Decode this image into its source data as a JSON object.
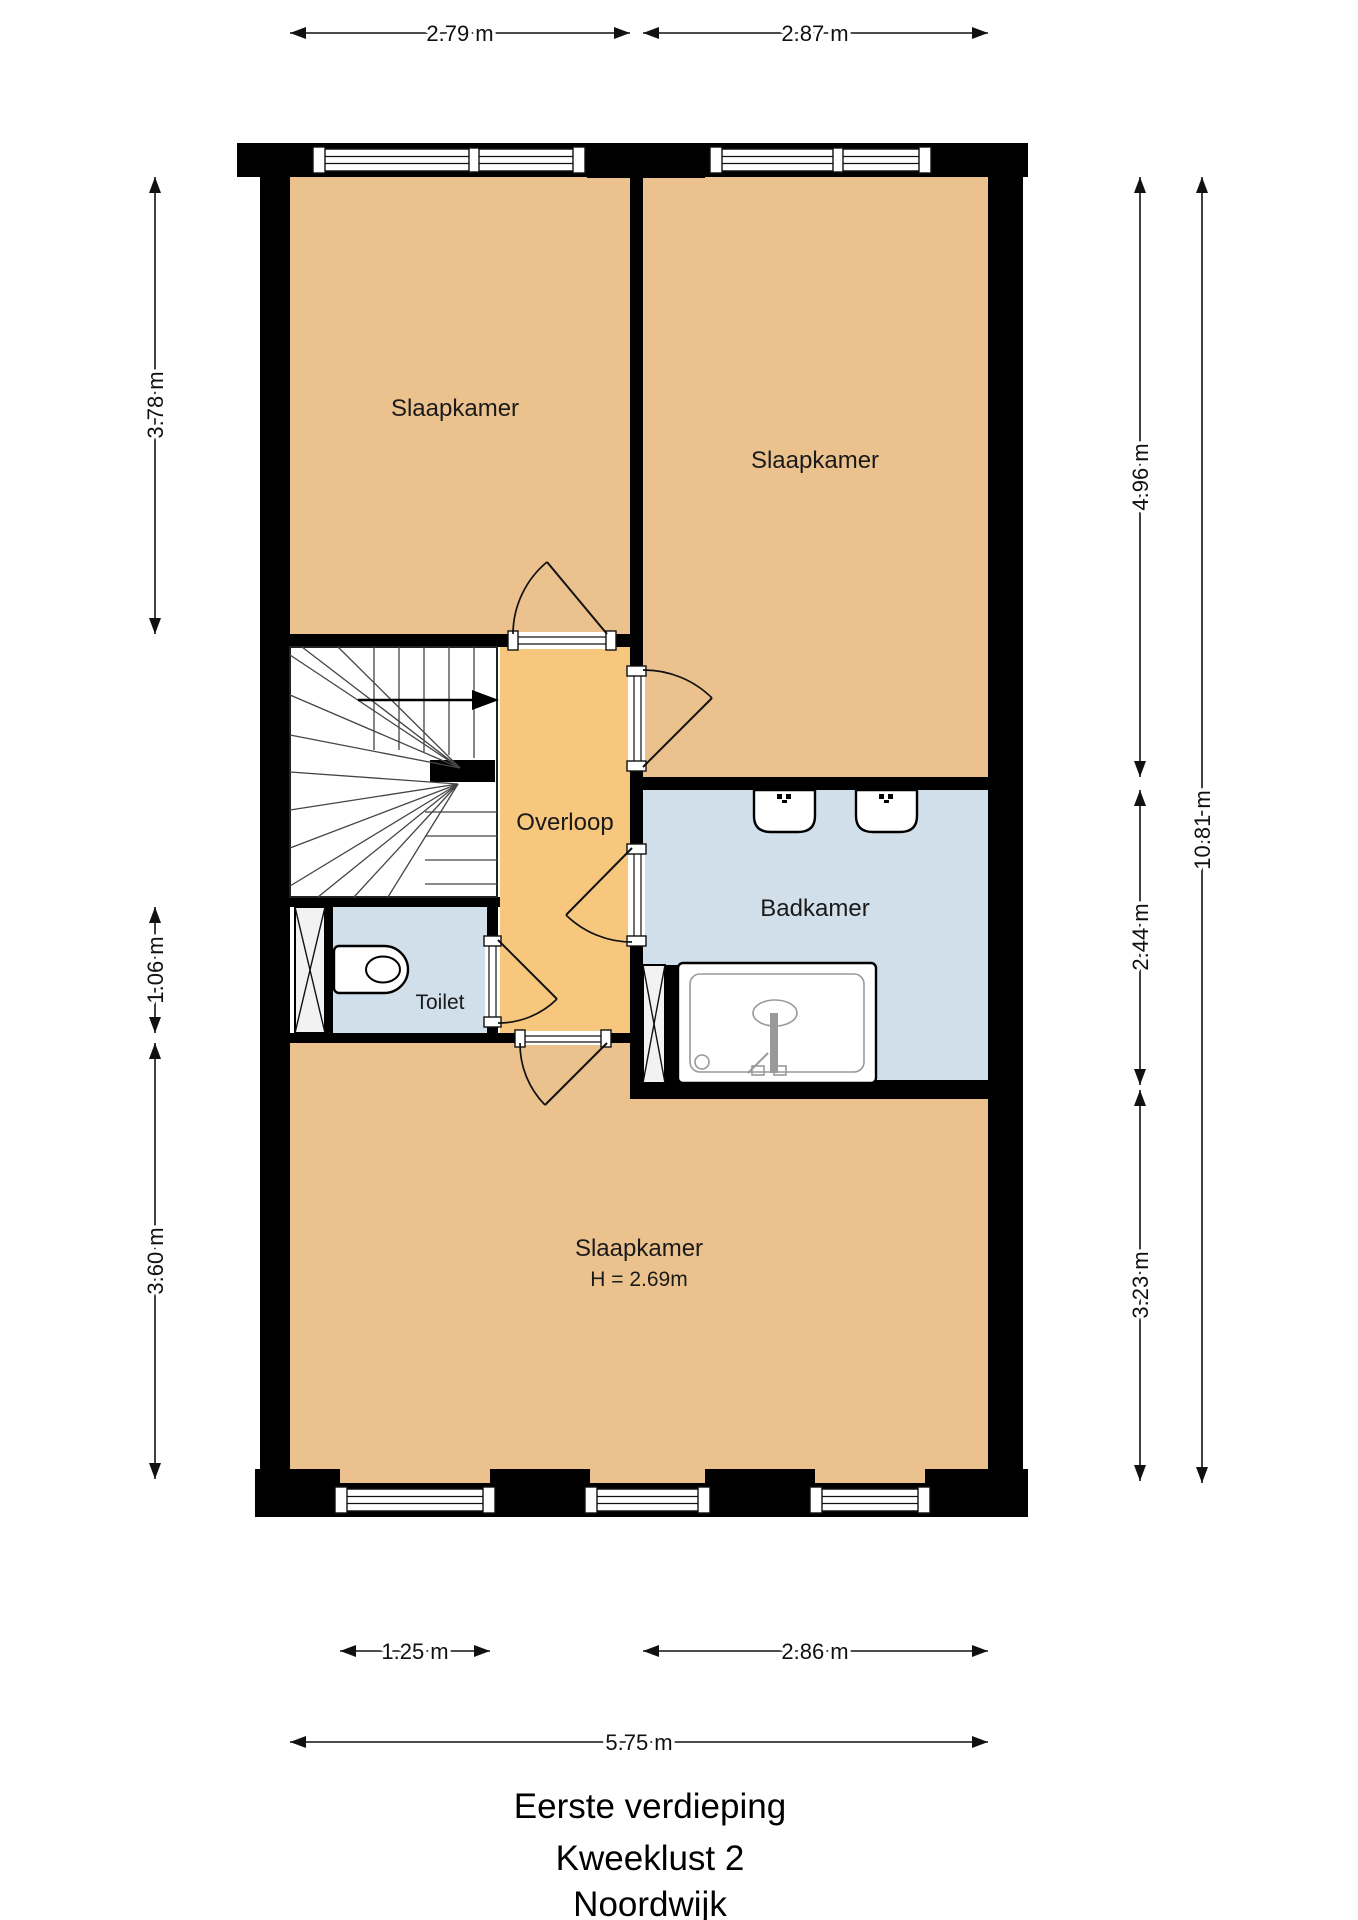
{
  "title": {
    "floor": "Eerste verdieping",
    "project": "Kweeklust 2",
    "city": "Noordwijk"
  },
  "rooms": {
    "bedroom_top_left": "Slaapkamer",
    "bedroom_top_right": "Slaapkamer",
    "bedroom_bottom": "Slaapkamer",
    "bedroom_bottom_ceiling_height": "H = 2.69m",
    "landing": "Overloop",
    "bathroom": "Badkamer",
    "toilet": "Toilet"
  },
  "dimensions": {
    "top": [
      {
        "label": "2.79 m"
      },
      {
        "label": "2.87 m"
      }
    ],
    "left": [
      {
        "label": "3.78 m"
      },
      {
        "label": "1.06 m"
      },
      {
        "label": "3.60 m"
      }
    ],
    "right_inner": [
      {
        "label": "4.96 m"
      },
      {
        "label": "2.44 m"
      },
      {
        "label": "3.23 m"
      }
    ],
    "right_outer": {
      "label": "10.81 m"
    },
    "bottom": [
      {
        "label": "1.25 m"
      },
      {
        "label": "2.86 m"
      }
    ],
    "overall_width": {
      "label": "5.75 m"
    }
  },
  "colors": {
    "room_fill": "#EBC28D",
    "landing_fill": "#F7C77E",
    "wet_room_fill": "#D0DFEA",
    "wall": "#000000",
    "shaft_fill": "#F2F2F2",
    "background": "#FFFFFF"
  }
}
